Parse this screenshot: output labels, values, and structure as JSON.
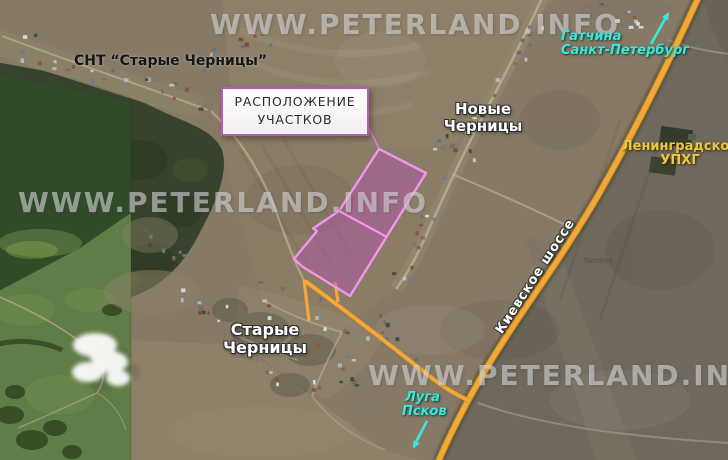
{
  "watermark": {
    "site": "WWW.PETERLAND.INFO",
    "map_provider": "Yandex"
  },
  "callout": {
    "line1": "РАСПОЛОЖЕНИЕ",
    "line2": "УЧАСТКОВ"
  },
  "settlements": {
    "snt": "СНТ “Старые Черницы”",
    "novye_line1": "Новые",
    "novye_line2": "Черницы",
    "starye_line1": "Старые",
    "starye_line2": "Черницы"
  },
  "directions": {
    "north_line1": "Гатчина",
    "north_line2": "Санкт-Петербург",
    "south_line1": "Луга",
    "south_line2": "Псков"
  },
  "highway": {
    "name": "Киевское шоссе"
  },
  "poi": {
    "upkhg_line1": "Ленинградское",
    "upkhg_line2": "УПХГ"
  },
  "colors": {
    "highway_orange": "#f3a93a",
    "road_casing": "#bf831d",
    "plots_fill": "rgba(176,88,168,0.52)",
    "plots_stroke": "#f096ec",
    "callout_border": "#b45cb5",
    "direction_cyan": "#3ae8d8",
    "poi_yellow": "#eac93e",
    "label_white": "#ffffff",
    "watermark_gray": "rgba(229,229,232,0.55)"
  }
}
